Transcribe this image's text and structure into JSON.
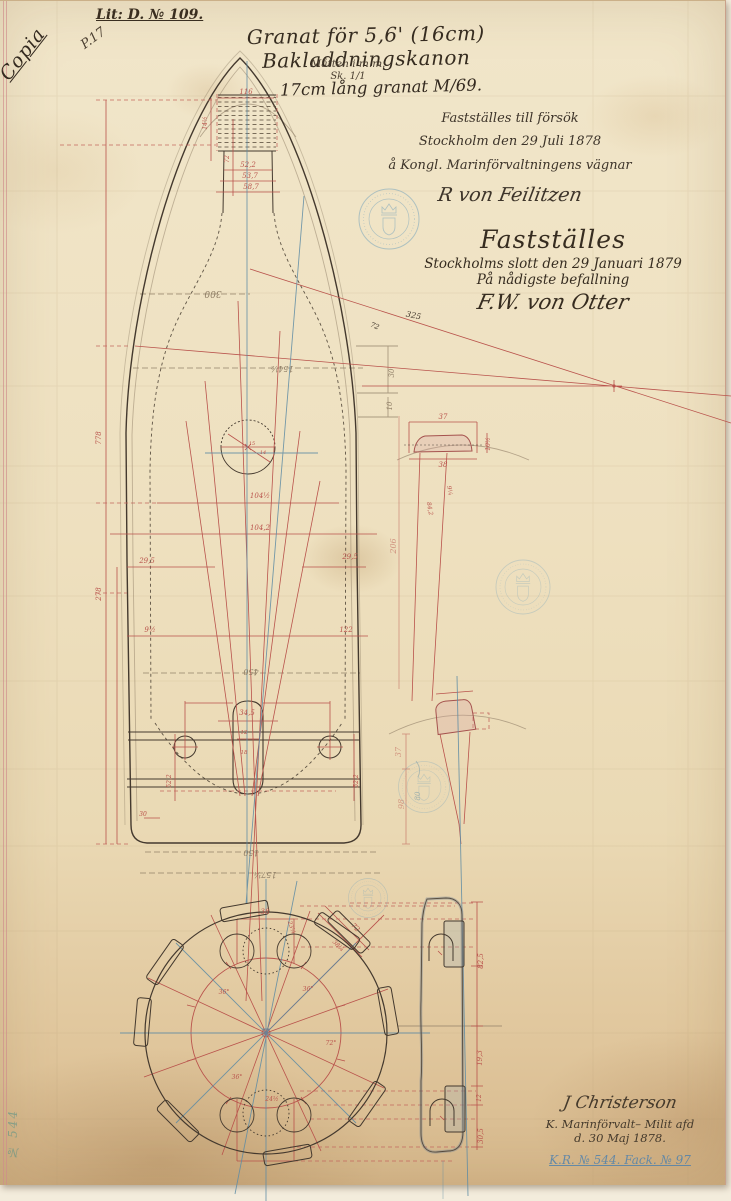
{
  "document": {
    "copy_mark": "Copia",
    "page_mark": "P.17",
    "lit_ref": "Lit: D. № 109.",
    "title": "Granat för 5,6' (16cm) Bakladdningskanon",
    "units_note": "Måtten i m.m.",
    "scale_note": "Sk. 1/1",
    "subtitle": "17cm lång granat M/69.",
    "approval_trial": {
      "line1": "Fastställes till försök",
      "line2": "Stockholm den 29 Juli 1878",
      "line3": "å Kongl. Marinförvaltningens vägnar",
      "signature": "R von Feilitzen"
    },
    "approval_final": {
      "line1": "Fastställes",
      "line2": "Stockholms slott den 29 Januari 1879",
      "line3": "På nådigste befallning",
      "signature": "F.W. von Otter"
    },
    "drafter": {
      "signature": "J Christerson",
      "line2": "K. Marinförvalt– Milit afd",
      "line3": "d. 30 Maj 1878.",
      "archive_ref": "K.R. № 544. Fack. № 97"
    },
    "margin_mark": "№ 544"
  },
  "drawing": {
    "colors": {
      "ink": "#44392e",
      "red": "#b9534c",
      "pencil": "#8d7c64",
      "blue": "#5d8ba4",
      "stamp": "#6e9fbb"
    },
    "labels": [
      {
        "t": "116",
        "x": 246,
        "y": 93,
        "c": "red",
        "s": 7,
        "r": 0
      },
      {
        "t": "14½",
        "x": 207,
        "y": 122,
        "c": "red",
        "s": 6,
        "r": -90
      },
      {
        "t": "72",
        "x": 229,
        "y": 158,
        "c": "red",
        "s": 6,
        "r": -90
      },
      {
        "t": "52,2",
        "x": 248,
        "y": 166,
        "c": "red",
        "s": 7,
        "r": 0
      },
      {
        "t": "53,7",
        "x": 250,
        "y": 177,
        "c": "red",
        "s": 7,
        "r": 0
      },
      {
        "t": "58,7",
        "x": 251,
        "y": 188,
        "c": "red",
        "s": 7,
        "r": 0
      },
      {
        "t": "300",
        "x": 213,
        "y": 290,
        "c": "pencil",
        "s": 9,
        "r": 180
      },
      {
        "t": "325",
        "x": 413,
        "y": 317,
        "c": "ink",
        "s": 8,
        "r": 12
      },
      {
        "t": "72",
        "x": 374,
        "y": 327,
        "c": "ink",
        "s": 7,
        "r": 22
      },
      {
        "t": "154½",
        "x": 282,
        "y": 365,
        "c": "pencil",
        "s": 8,
        "r": 180
      },
      {
        "t": "30",
        "x": 394,
        "y": 372,
        "c": "pencil",
        "s": 7,
        "r": -90
      },
      {
        "t": "10",
        "x": 392,
        "y": 405,
        "c": "pencil",
        "s": 7,
        "r": -90
      },
      {
        "t": "778",
        "x": 101,
        "y": 437,
        "c": "red",
        "s": 7,
        "r": -90
      },
      {
        "t": "278",
        "x": 101,
        "y": 593,
        "c": "red",
        "s": 7,
        "r": -90
      },
      {
        "t": "15",
        "x": 252,
        "y": 444,
        "c": "red",
        "s": 5,
        "r": 0
      },
      {
        "t": "14",
        "x": 263,
        "y": 453,
        "c": "red",
        "s": 5,
        "r": 0
      },
      {
        "t": "104½",
        "x": 260,
        "y": 497,
        "c": "red",
        "s": 7,
        "r": 0
      },
      {
        "t": "104,2",
        "x": 260,
        "y": 529,
        "c": "red",
        "s": 7,
        "r": 0
      },
      {
        "t": "29,5",
        "x": 147,
        "y": 562,
        "c": "red",
        "s": 7,
        "r": 0
      },
      {
        "t": "29,5",
        "x": 350,
        "y": 558,
        "c": "red",
        "s": 7,
        "r": 0
      },
      {
        "t": "206",
        "x": 396,
        "y": 545,
        "c": "red",
        "s": 8,
        "r": -90,
        "o": 0.55
      },
      {
        "t": "9½",
        "x": 150,
        "y": 631,
        "c": "red",
        "s": 7,
        "r": 0
      },
      {
        "t": "122",
        "x": 346,
        "y": 631,
        "c": "red",
        "s": 7,
        "r": 0
      },
      {
        "t": "450",
        "x": 251,
        "y": 668,
        "c": "pencil",
        "s": 8,
        "r": 180
      },
      {
        "t": "34,5",
        "x": 247,
        "y": 714,
        "c": "red",
        "s": 7,
        "r": 0
      },
      {
        "t": "12",
        "x": 244,
        "y": 733,
        "c": "red",
        "s": 5.5,
        "r": 0
      },
      {
        "t": "18",
        "x": 244,
        "y": 753,
        "c": "red",
        "s": 5.5,
        "r": 0
      },
      {
        "t": "52,2",
        "x": 171,
        "y": 780,
        "c": "red",
        "s": 6,
        "r": -90
      },
      {
        "t": "52,2",
        "x": 358,
        "y": 780,
        "c": "red",
        "s": 6,
        "r": -90
      },
      {
        "t": "30",
        "x": 143,
        "y": 815,
        "c": "red",
        "s": 6,
        "r": 0
      },
      {
        "t": "150",
        "x": 251,
        "y": 849,
        "c": "pencil",
        "s": 8,
        "r": 180
      },
      {
        "t": "157¼",
        "x": 265,
        "y": 871,
        "c": "pencil",
        "s": 8,
        "r": 180
      },
      {
        "t": "37",
        "x": 443,
        "y": 418,
        "c": "red",
        "s": 7,
        "r": 0
      },
      {
        "t": "38",
        "x": 443,
        "y": 466,
        "c": "red",
        "s": 7,
        "r": 0
      },
      {
        "t": "10½",
        "x": 490,
        "y": 443,
        "c": "red",
        "s": 6,
        "r": -90
      },
      {
        "t": "9¼",
        "x": 448,
        "y": 490,
        "c": "red",
        "s": 6,
        "r": 78
      },
      {
        "t": "84,2",
        "x": 428,
        "y": 508,
        "c": "red",
        "s": 6,
        "r": 80
      },
      {
        "t": "37",
        "x": 401,
        "y": 751,
        "c": "red",
        "s": 8,
        "r": -90,
        "o": 0.5
      },
      {
        "t": "98",
        "x": 404,
        "y": 803,
        "c": "red",
        "s": 8,
        "r": -90,
        "o": 0.5
      },
      {
        "t": "80",
        "x": 420,
        "y": 795,
        "c": "blue",
        "s": 7,
        "r": -90,
        "o": 0.55
      },
      {
        "t": "82,5",
        "x": 483,
        "y": 960,
        "c": "red",
        "s": 7,
        "r": -90
      },
      {
        "t": "19,3",
        "x": 482,
        "y": 1057,
        "c": "red",
        "s": 7,
        "r": -90
      },
      {
        "t": "12",
        "x": 481,
        "y": 1097,
        "c": "red",
        "s": 6,
        "r": -90
      },
      {
        "t": "30,5",
        "x": 483,
        "y": 1135,
        "c": "red",
        "s": 7,
        "r": -90
      },
      {
        "t": "38",
        "x": 265,
        "y": 913,
        "c": "red",
        "s": 7,
        "r": 0
      },
      {
        "t": "72",
        "x": 354,
        "y": 928,
        "c": "red",
        "s": 7,
        "r": 45
      },
      {
        "t": "38¼",
        "x": 337,
        "y": 946,
        "c": "red",
        "s": 6,
        "r": 45
      },
      {
        "t": "23¼",
        "x": 290,
        "y": 927,
        "c": "red",
        "s": 6,
        "r": 70
      },
      {
        "t": "36°",
        "x": 224,
        "y": 993,
        "c": "red",
        "s": 6,
        "r": 0
      },
      {
        "t": "36°",
        "x": 308,
        "y": 990,
        "c": "red",
        "s": 6,
        "r": 0
      },
      {
        "t": "36°",
        "x": 237,
        "y": 1078,
        "c": "red",
        "s": 6,
        "r": 0
      },
      {
        "t": "72°",
        "x": 331,
        "y": 1044,
        "c": "red",
        "s": 6,
        "r": 0
      },
      {
        "t": "24½",
        "x": 272,
        "y": 1100,
        "c": "red",
        "s": 6,
        "r": 0
      }
    ]
  }
}
